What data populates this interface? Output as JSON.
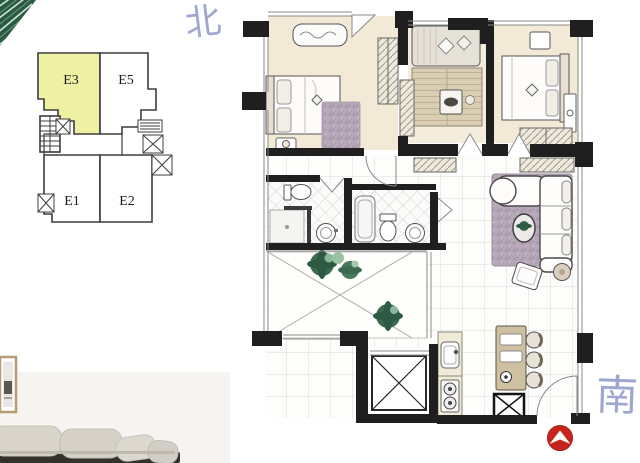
{
  "canvas": {
    "background_color": "#ffffff"
  },
  "compass": {
    "north_label": "北",
    "south_label": "南",
    "ink_color": "#96a0cb"
  },
  "key_plan": {
    "selected_unit": "E3",
    "highlight_color": "#eef0a4",
    "outline_color": "#3d3d3d",
    "units": [
      {
        "label": "E3",
        "highlighted": true
      },
      {
        "label": "E5",
        "highlighted": false
      },
      {
        "label": "E1",
        "highlighted": false
      },
      {
        "label": "E2",
        "highlighted": false
      }
    ]
  },
  "floor_plan": {
    "wall_color": "#1f1f1f",
    "entrance_marker": {
      "icon": "arrow-up-icon",
      "color": "#c5251d"
    }
  }
}
